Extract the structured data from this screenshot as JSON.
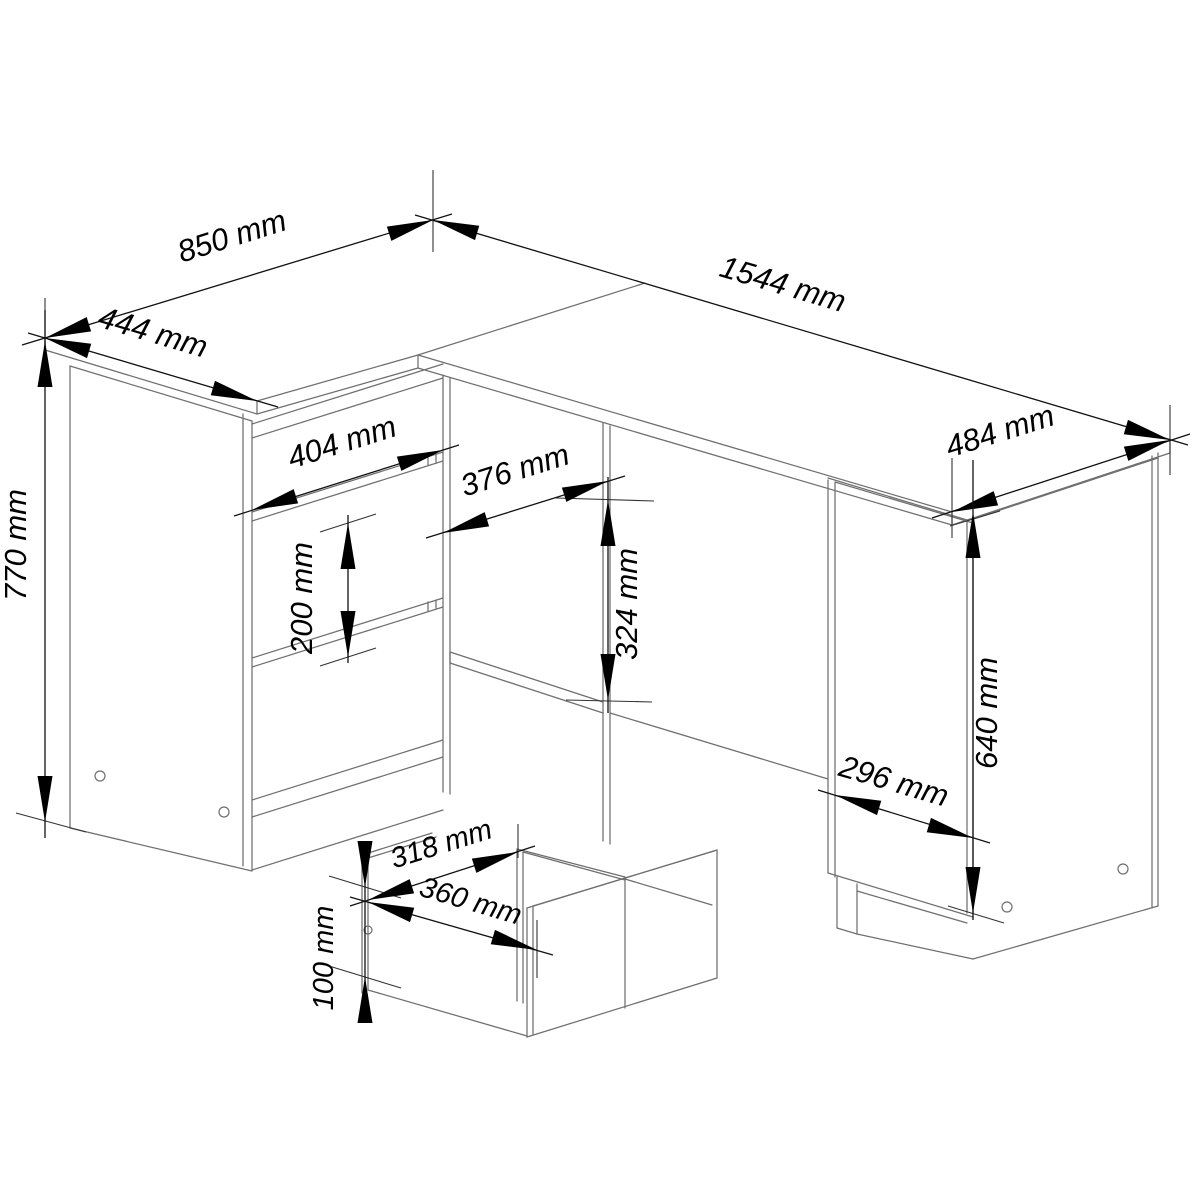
{
  "diagram": {
    "type": "technical-drawing",
    "subject": "L-shaped corner desk with drawer pedestal - dimensioned isometric wireframe with exploded drawer-box detail",
    "units": "mm",
    "background_color": "#ffffff",
    "body_line_color": "#6f6f6f",
    "dimension_color": "#000000",
    "labels": {
      "return_top_depth": "850 mm",
      "return_top_width": "444 mm",
      "desktop_length": "1544 mm",
      "desktop_end_depth": "484 mm",
      "desk_height": "770 mm",
      "drawer_front_width": "404 mm",
      "knee_opening_width": "376 mm",
      "knee_opening_height": "324 mm",
      "drawer_front_height": "200 mm",
      "pedestal_width": "296 mm",
      "pedestal_height": "640 mm",
      "drawer_box_inner_width": "318 mm",
      "drawer_box_outer_width": "360 mm",
      "drawer_box_height": "100 mm"
    }
  }
}
